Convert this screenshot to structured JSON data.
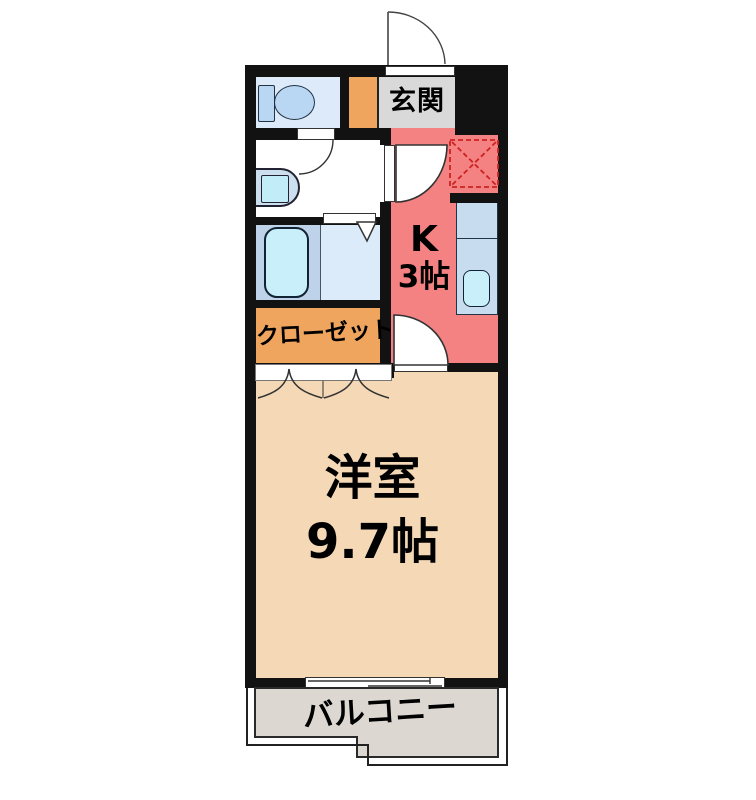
{
  "page": {
    "type": "apartment-floorplan",
    "background": "#ffffff"
  },
  "rooms": {
    "entrance": {
      "label": "玄関"
    },
    "kitchen": {
      "label": "K",
      "size": "3帖"
    },
    "closet": {
      "label": "クローゼット"
    },
    "western_room": {
      "label": "洋室",
      "size": "9.7帖"
    },
    "balcony": {
      "label": "バルコニー"
    }
  },
  "icons": [
    "toilet-icon",
    "washbasin-icon",
    "bathtub-icon",
    "kitchen-sink-icon",
    "kitchen-counter-icon",
    "refrigerator-space-icon",
    "entrance-door-arc-icon",
    "interior-door-arc-icon",
    "bifold-closet-door-icon",
    "folding-bath-door-icon",
    "sliding-window-icon"
  ],
  "colors": {
    "wall_black": "#121212",
    "kitchen_pink": "#f58282",
    "storage_orange": "#f0a55f",
    "room_beige": "#f5d8b6",
    "balcony_gray": "#dcd7d1",
    "entrance_gray": "#d9d9d9",
    "toilet_room_blue": "#dceafa",
    "bath_blue_dark": "#bed3ea",
    "bath_blue_light": "#dcebfa",
    "fixture_cyan": "#c9f0fa",
    "counter_blue": "#c8dcf0",
    "refrigerator_dashed_red": "#cc2222"
  }
}
